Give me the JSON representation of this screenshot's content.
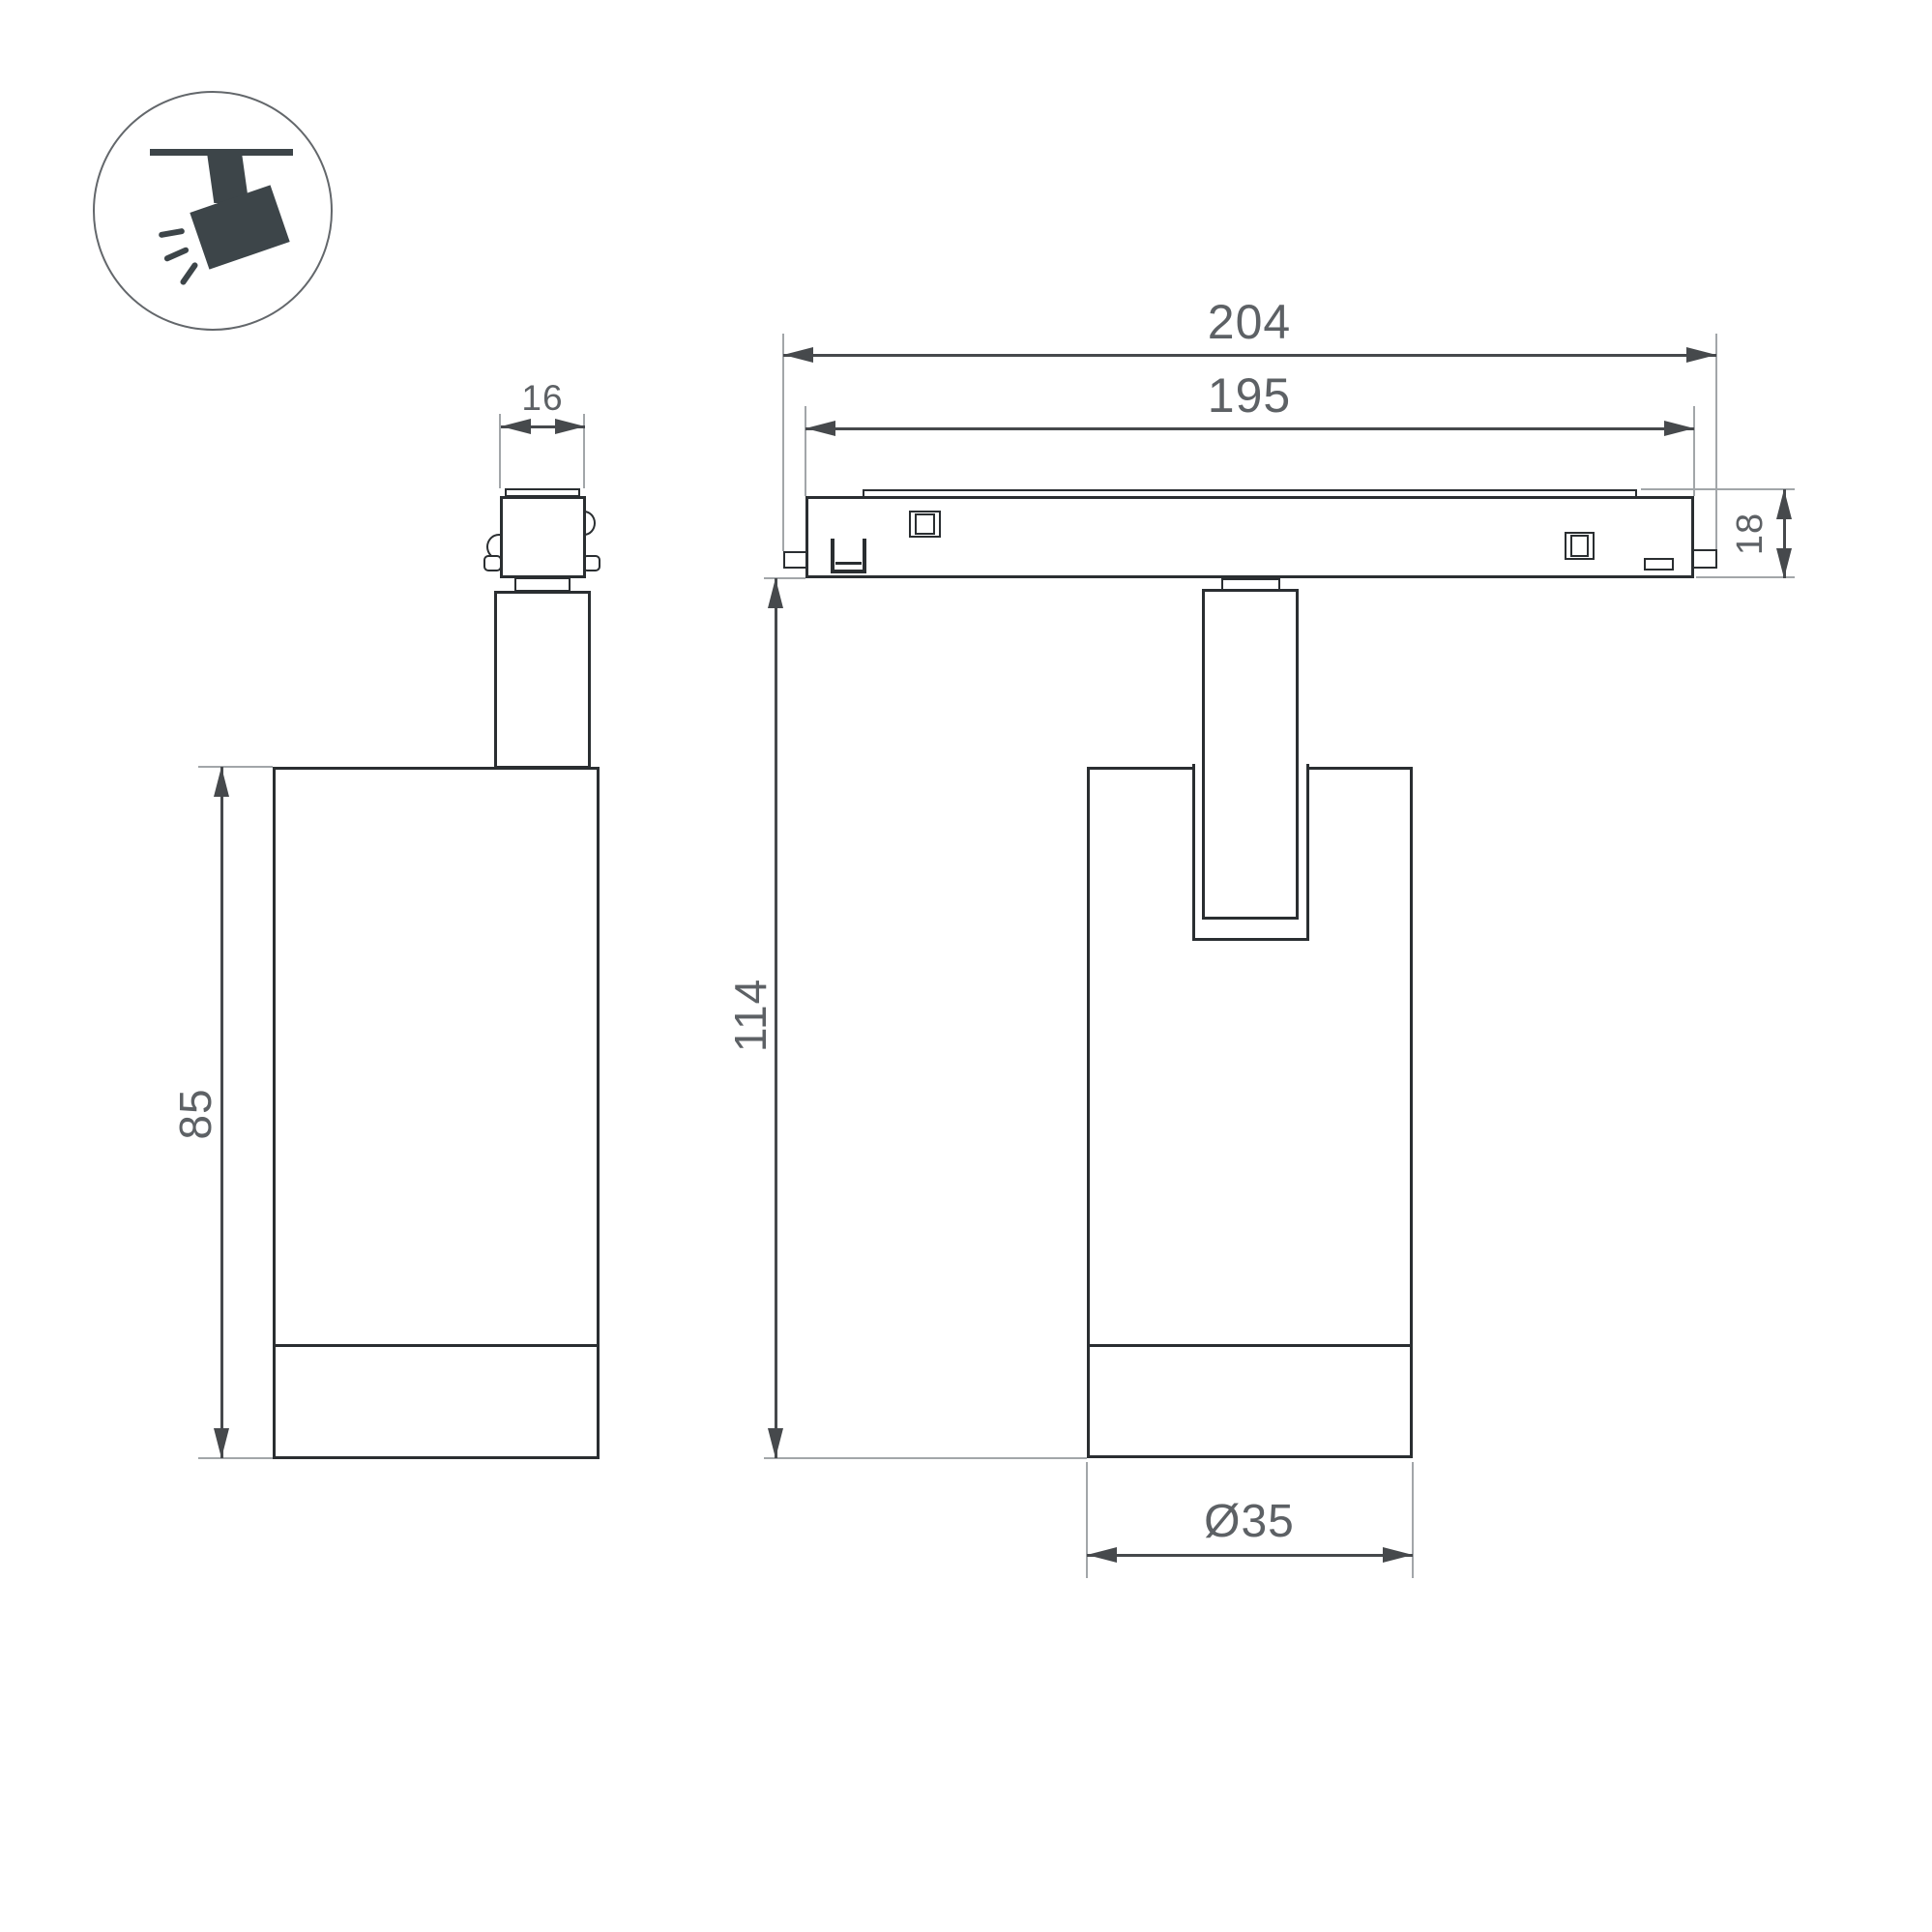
{
  "dims": {
    "adapter_width": "16",
    "body_height": "85",
    "overall_length": "204",
    "track_length": "195",
    "track_height": "18",
    "overall_height": "114",
    "body_diameter": "Ø35"
  },
  "icon": {
    "name": "ceiling-track-spotlight",
    "fill": "#3d4549",
    "ring": "#63676b"
  },
  "style": {
    "outline_color": "#2a2e31",
    "dimension_color": "#46494c",
    "extension_color": "#a2a6a9",
    "text_color": "#5d6165",
    "background": "#ffffff"
  }
}
